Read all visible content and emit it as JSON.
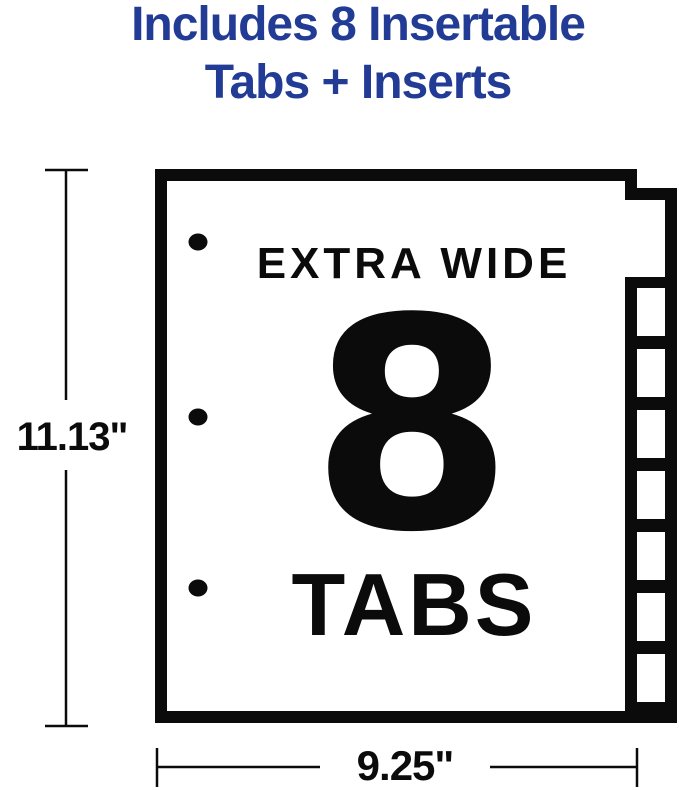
{
  "heading": {
    "line1": "Includes 8 Insertable",
    "line2": "Tabs + Inserts"
  },
  "sheet": {
    "badge_top": "EXTRA WIDE",
    "badge_number": "8",
    "badge_bottom": "TABS",
    "tab_count": 8,
    "tab_windows": 7,
    "punch_holes": 3
  },
  "dimensions": {
    "height": "11.13\"",
    "width": "9.25\""
  },
  "colors": {
    "heading_blue": "#223c96",
    "ink": "#0b0b0b",
    "background": "#ffffff"
  }
}
